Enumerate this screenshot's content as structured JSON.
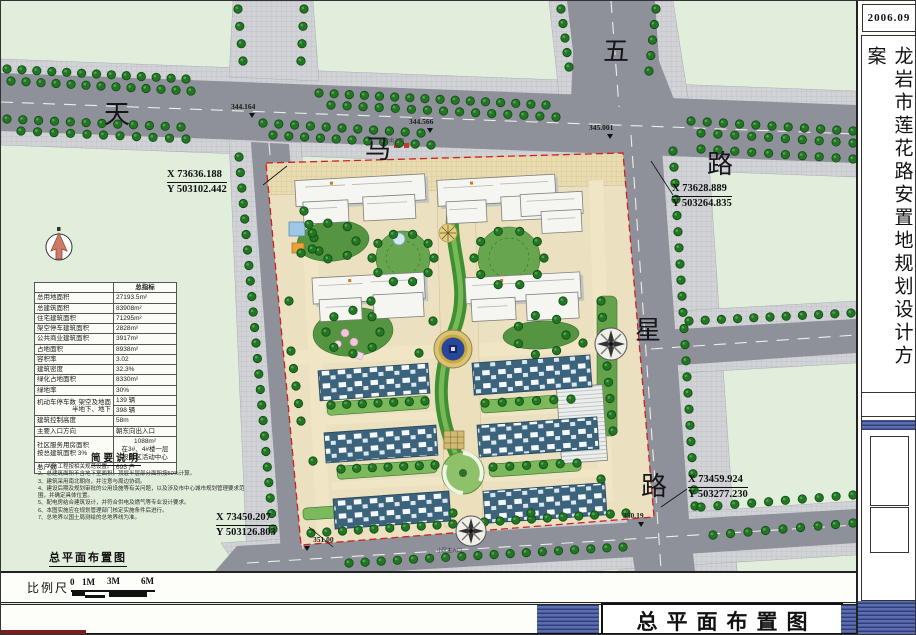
{
  "title_block": {
    "date": "2006.09",
    "project_title": "龙岩市莲花路安置地规划设计方案",
    "sheet_title": "总平面布置图"
  },
  "plan_label": "总平面布置图",
  "roads": {
    "tianma": [
      "天",
      "马",
      "路"
    ],
    "wuxing": [
      "五",
      "星",
      "路"
    ]
  },
  "elevations": [
    "344.164",
    "344.566",
    "345.001",
    "351.00",
    "350.19"
  ],
  "coords": {
    "tl": {
      "x": "X 73636.188",
      "y": "Y 503102.442"
    },
    "tr": {
      "x": "X 73628.889",
      "y": "Y 503264.835"
    },
    "br": {
      "x": "X 73459.924",
      "y": "Y 503277.230"
    },
    "bl": {
      "x": "X 73450.207",
      "y": "Y 503126.803"
    }
  },
  "entrances": {
    "commercial": "商业出入口",
    "main": "小区主入口"
  },
  "indicator_table": {
    "header": "总指标",
    "rows": [
      {
        "label": "总用地面积",
        "value": "27193.5m²"
      },
      {
        "label": "总建筑面积",
        "value": "83908m²"
      },
      {
        "label": "住宅建筑面积",
        "value": "71295m²"
      },
      {
        "label": "架空停车建筑面积",
        "value": "2828m²"
      },
      {
        "label": "公共商业建筑面积",
        "value": "3917m²"
      },
      {
        "label": "占地面积",
        "value": "8938m²"
      },
      {
        "label": "容积率",
        "value": "3.02"
      },
      {
        "label": "建筑密度",
        "value": "32.3%"
      },
      {
        "label": "绿化占地面积",
        "value": "8330m²"
      },
      {
        "label": "绿地率",
        "value": "30%"
      }
    ],
    "parking": {
      "label": "机动车停车数",
      "sub1": "架空及地面",
      "v1": "139 辆",
      "sub2": "半地下、地下",
      "v2": "398 辆"
    },
    "rows2": [
      {
        "label": "建筑控制高度",
        "value": "58m"
      },
      {
        "label": "主要入口方向",
        "value": "朝东向出入口"
      }
    ],
    "service": {
      "label1": "社区服务用房面积",
      "label2": "按总建筑面积 3%",
      "value1": "1088m²",
      "value2": "在3#、4#楼一层",
      "value3": "设社区活动中心"
    },
    "total": {
      "label": "总户数",
      "value": "695 户"
    }
  },
  "notes": {
    "title": "简要说明",
    "items": [
      "1、人防工程按相关规范设置。",
      "2、总建筑面积不含地下室面积，顶层半层部分面积按50%计算。",
      "3、建筑采用南北朝向，并注意与周边协调。",
      "4、建设后期及规划审批的公用设施等有关问题，以及涉及市中心城市规划管理要求范围，并确定具体位置。",
      "5、配电房结合建筑设计，并符合供电及燃气等专业设计要求。",
      "6、本图实施应在规划管理部门核定实施条件后进行。",
      "7、总地界以国土局测绘的总地界线为准。"
    ]
  },
  "scale": {
    "label": "比例尺",
    "ticks": [
      "0",
      "1M",
      "3M",
      "6M"
    ]
  },
  "colors": {
    "background": "#e0edda",
    "road": "#8e909a",
    "site_boundary": "#cf2020",
    "tree": "#237623",
    "townhouse_roof": "#3c637c",
    "title_bar_blue": "#4a5fa0",
    "north_arrow": "#cf7a66"
  }
}
